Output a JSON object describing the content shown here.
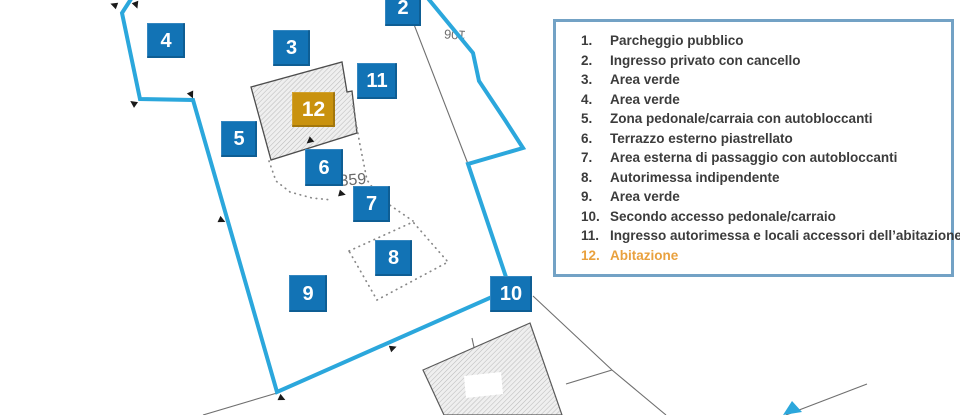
{
  "legend": {
    "items": [
      {
        "num": "1.",
        "label": "Parcheggio pubblico"
      },
      {
        "num": "2.",
        "label": "Ingresso privato con cancello"
      },
      {
        "num": "3.",
        "label": "Area verde"
      },
      {
        "num": "4.",
        "label": "Area verde"
      },
      {
        "num": "5.",
        "label": "Zona pedonale/carraia con autobloccanti"
      },
      {
        "num": "6.",
        "label": "Terrazzo esterno piastrellato"
      },
      {
        "num": "7.",
        "label": "Area esterna di passaggio con autobloccanti"
      },
      {
        "num": "8.",
        "label": "Autorimessa indipendente"
      },
      {
        "num": "9.",
        "label": "Area verde"
      },
      {
        "num": "10.",
        "label": "Secondo accesso pedonale/carraio"
      },
      {
        "num": "11.",
        "label": "Ingresso autorimessa e locali accessori dell’abitazione"
      },
      {
        "num": "12.",
        "label": "Abitazione",
        "highlight": true
      }
    ]
  },
  "map": {
    "labels": {
      "parcel_359": "359",
      "parcel_rotated": "106"
    },
    "markers": [
      {
        "label": "2",
        "x": 385,
        "y": -11,
        "w": 36,
        "h": 37,
        "type": "blue"
      },
      {
        "label": "3",
        "x": 273,
        "y": 30,
        "w": 37,
        "h": 36,
        "type": "blue"
      },
      {
        "label": "4",
        "x": 147,
        "y": 23,
        "w": 38,
        "h": 35,
        "type": "blue"
      },
      {
        "label": "5",
        "x": 221,
        "y": 121,
        "w": 36,
        "h": 36,
        "type": "blue"
      },
      {
        "label": "6",
        "x": 305,
        "y": 149,
        "w": 38,
        "h": 37,
        "type": "blue"
      },
      {
        "label": "7",
        "x": 353,
        "y": 186,
        "w": 37,
        "h": 36,
        "type": "blue"
      },
      {
        "label": "8",
        "x": 375,
        "y": 240,
        "w": 37,
        "h": 36,
        "type": "blue"
      },
      {
        "label": "9",
        "x": 289,
        "y": 275,
        "w": 38,
        "h": 37,
        "type": "blue"
      },
      {
        "label": "10",
        "x": 490,
        "y": 276,
        "w": 42,
        "h": 36,
        "type": "blue"
      },
      {
        "label": "11",
        "x": 357,
        "y": 63,
        "w": 40,
        "h": 36,
        "type": "blue"
      },
      {
        "label": "12",
        "x": 292,
        "y": 92,
        "w": 43,
        "h": 35,
        "type": "orange"
      }
    ]
  },
  "colors": {
    "marker_blue": "#1273B5",
    "marker_orange": "#C9920E",
    "boundary": "#2BA7DC",
    "legend_border": "#73A2C5",
    "legend_text": "#3C3C3C",
    "legend_highlight": "#E9A13E"
  }
}
